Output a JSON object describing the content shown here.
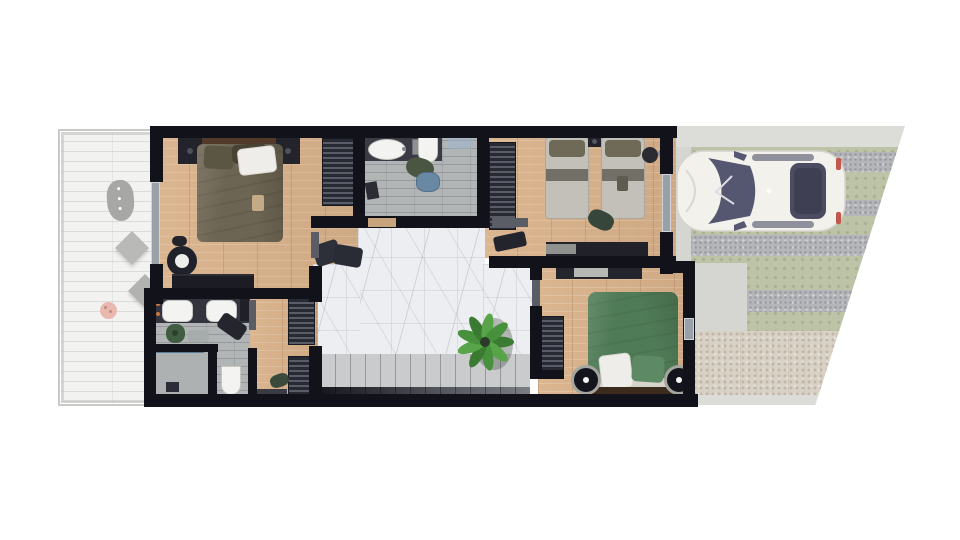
{
  "palette": {
    "wall": "#12131a",
    "oakbase": "#d9b28a",
    "graywood": "#b2b5b5",
    "marblebase": "#edeef1",
    "deckbase": "#f2f2f0",
    "lawn": "#bcc3a6",
    "gravel": "#b5b6ba",
    "patio": "#d8d1c5",
    "concrete": "#d5d6d2",
    "stripcol": "#dcdcd8",
    "furndark": "#22232b",
    "slatline": "#5a5c68",
    "doorcol": "#5a5c66",
    "windowcol": "#9aa0a8",
    "stairlight": "#c9cbcd",
    "stairdark": "#7a7d82",
    "sinkwhite": "#f3f3f1",
    "carbody": "#f3f1ec",
    "carglass": "#555770",
    "masterduvet": "#6d6553",
    "greenduvet": "#507b57",
    "greenpillow": "#5d8a64",
    "pillowwhite": "#eeede9",
    "pillowolive": "#5b5644",
    "twinblanket": "#c2c0b9",
    "twinband": "#716f66",
    "twinpillow": "#6f6a57",
    "headwood": "#53392a",
    "plantdark": "#3b7a31",
    "plantlight": "#57a449",
    "laundrygreen": "#4a5542",
    "basketblue": "#6988a3",
    "stoolpink": "#e9b9af"
  },
  "scene": {
    "type": "floor-plan-render-top-view",
    "deck": {
      "name": "wooden-deck",
      "furniture": [
        "lounge-chair",
        "side-table",
        "side-table",
        "round-stool"
      ]
    },
    "rooms": [
      {
        "name": "master-bedroom",
        "floor": "oak-planks",
        "furniture": [
          "double-bed",
          "nightstand-left",
          "nightstand-right",
          "wardrobe",
          "round-chair",
          "dresser",
          "bags"
        ]
      },
      {
        "name": "bathroom-top",
        "floor": "gray-wood",
        "furniture": [
          "vanity-basin",
          "toilet",
          "laundry-pile",
          "laundry-basket",
          "glass-shelf"
        ]
      },
      {
        "name": "kids-bedroom",
        "floor": "oak-planks",
        "furniture": [
          "twin-bed-left",
          "twin-bed-right",
          "nightstand",
          "side-table",
          "wardrobe",
          "dresser",
          "clothes-pile",
          "bench"
        ]
      },
      {
        "name": "green-bedroom",
        "floor": "oak-planks",
        "furniture": [
          "double-bed-green",
          "bedside-table-left",
          "bedside-table-right",
          "desk",
          "wardrobe"
        ]
      },
      {
        "name": "hallway",
        "floor": "marble",
        "furniture": [
          "staircase",
          "potted-plant",
          "bags"
        ]
      },
      {
        "name": "entry-corridor",
        "floor": "oak-planks",
        "furniture": [
          "shoe-rack-top",
          "shoe-rack-bottom",
          "shoes",
          "doormat"
        ]
      },
      {
        "name": "bathroom-bottom",
        "floor": "gray-wood",
        "furniture": [
          "double-vanity",
          "floor-plant",
          "bath-mat",
          "robe",
          "toilet",
          "shower"
        ]
      }
    ],
    "yard": {
      "name": "driveway-and-garden",
      "elements": [
        "white-car",
        "lawn",
        "gravel-strips",
        "concrete-path",
        "stone-patio"
      ]
    }
  }
}
